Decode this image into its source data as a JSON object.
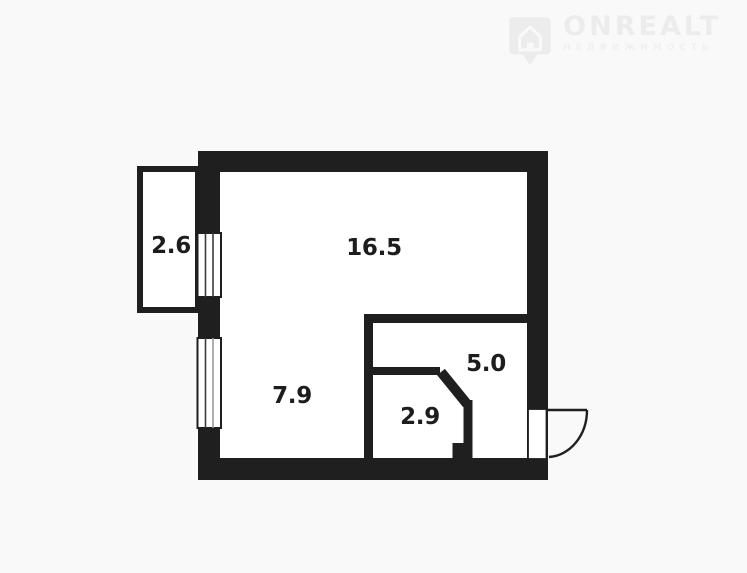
{
  "page": {
    "background": "#f9f9f9"
  },
  "logo": {
    "brand": "ONREALT",
    "subtitle": "НЕДВИЖИМОСТЬ",
    "icon": "house-pin-icon",
    "color": "#ececec",
    "subtitle_color": "#f0f0f0"
  },
  "floorplan": {
    "wall_color": "#1f1f1f",
    "room_fill": "#ffffff",
    "label_color": "#1d1d1d",
    "rooms": [
      {
        "id": "balcony",
        "area": "2.6"
      },
      {
        "id": "main-room",
        "area": "16.5"
      },
      {
        "id": "room-left",
        "area": "7.9"
      },
      {
        "id": "room-right",
        "area": "5.0"
      },
      {
        "id": "bathroom",
        "area": "2.9"
      }
    ]
  }
}
